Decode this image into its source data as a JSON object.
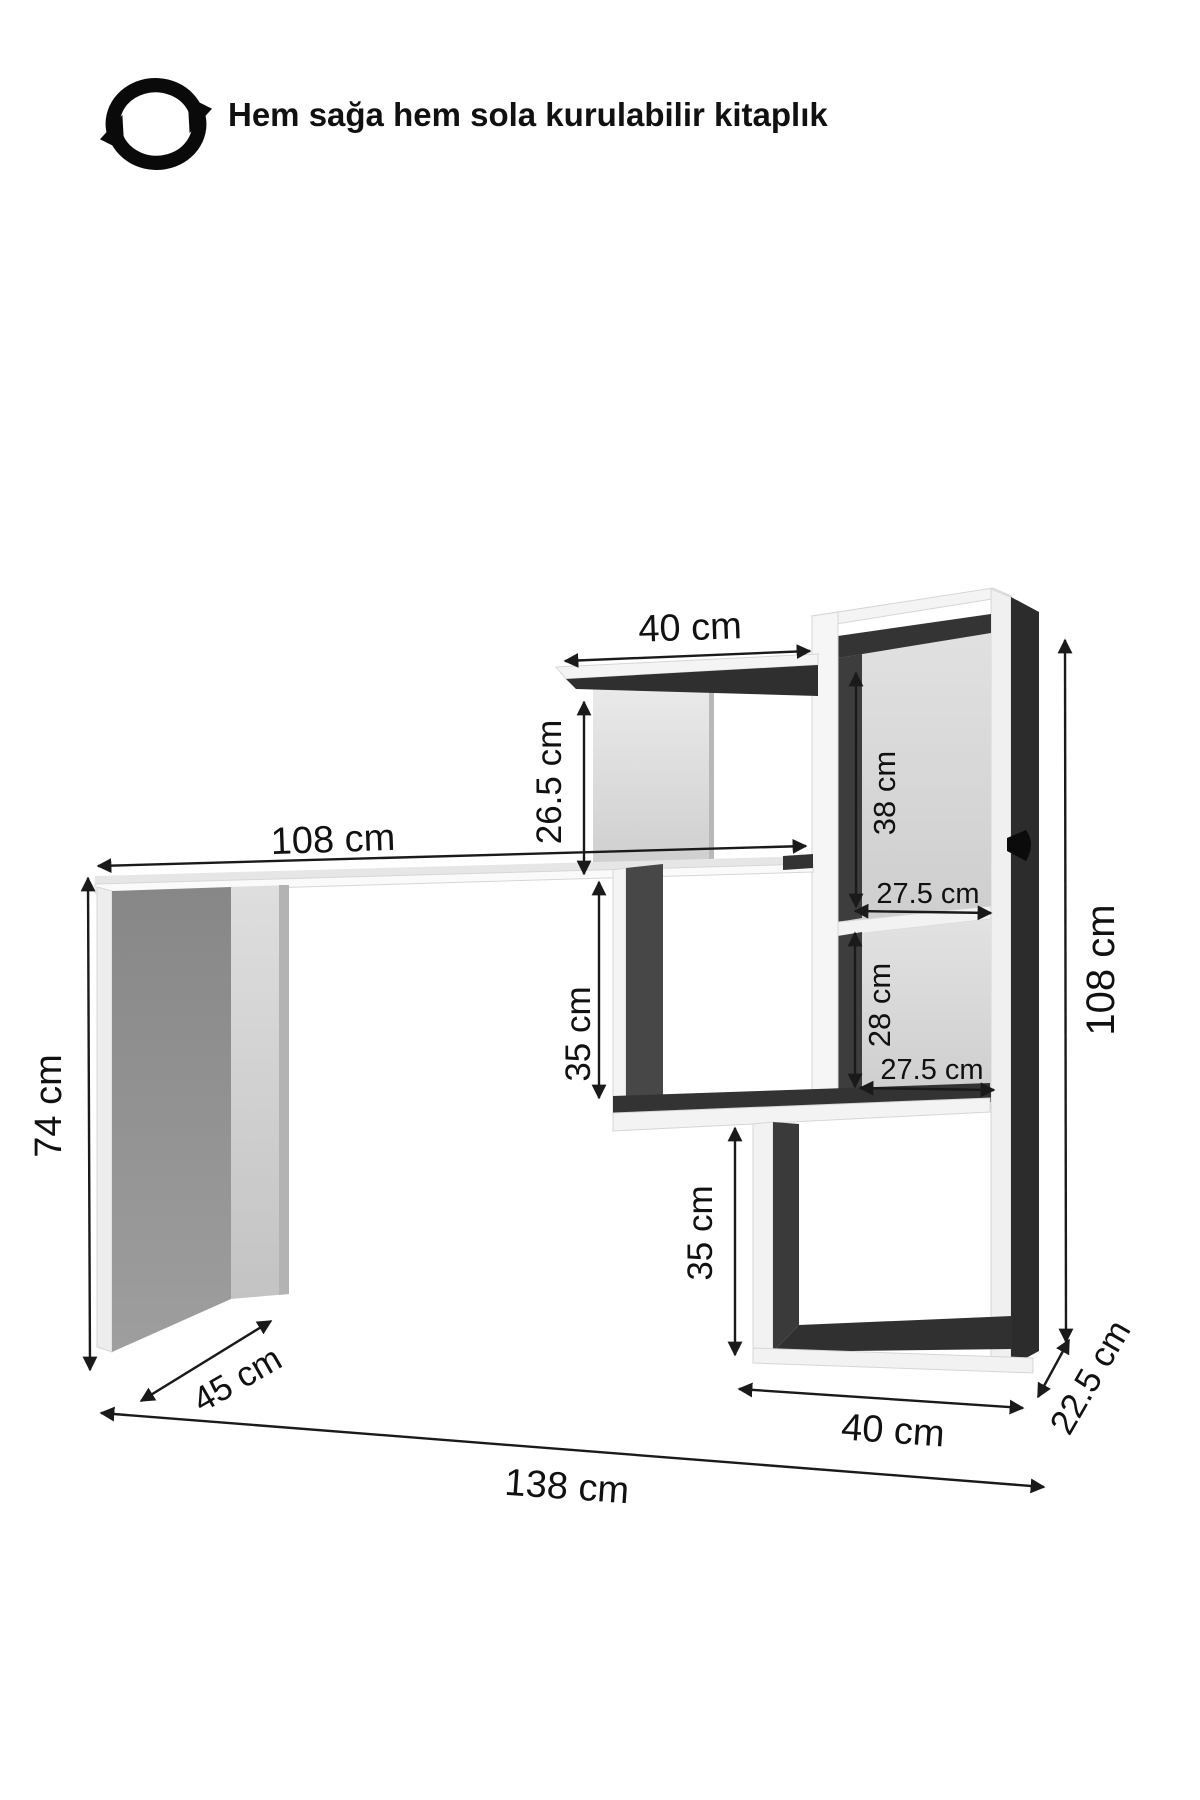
{
  "header": {
    "title": "Hem sağa hem sola kurulabilir kitaplık",
    "icon": "rotate-cycle-icon"
  },
  "diagram": {
    "type": "furniture-dimension-diagram",
    "subject": "desk with reversible bookshelf",
    "unit": "cm",
    "dimensions": {
      "top_shelf_width": {
        "label": "40 cm",
        "value": 40
      },
      "top_shelf_to_desk_gap": {
        "label": "26.5 cm",
        "value": 26.5
      },
      "desk_width": {
        "label": "108 cm",
        "value": 108
      },
      "cabinet_upper_compartment_height": {
        "label": "38 cm",
        "value": 38
      },
      "cabinet_upper_compartment_width": {
        "label": "27.5 cm",
        "value": 27.5
      },
      "desk_height": {
        "label": "74 cm",
        "value": 74
      },
      "middle_compartment_height": {
        "label": "35 cm",
        "value": 35
      },
      "cabinet_lower_compartment_height": {
        "label": "28 cm",
        "value": 28
      },
      "cabinet_lower_compartment_width": {
        "label": "27.5 cm",
        "value": 27.5
      },
      "bookshelf_total_height": {
        "label": "108 cm",
        "value": 108
      },
      "bottom_compartment_height": {
        "label": "35 cm",
        "value": 35
      },
      "desk_depth": {
        "label": "45 cm",
        "value": 45
      },
      "bottom_shelf_width": {
        "label": "40 cm",
        "value": 40
      },
      "bookshelf_depth": {
        "label": "22.5 cm",
        "value": 22.5
      },
      "total_width": {
        "label": "138 cm",
        "value": 138
      }
    },
    "colors": {
      "background": "#ffffff",
      "line": "#1a1a1a",
      "panel_dark": "#333333",
      "panel_light_gray": "#d8d8d8",
      "panel_white": "#f4f4f4",
      "leg_gray": "#8f8f8f"
    }
  }
}
